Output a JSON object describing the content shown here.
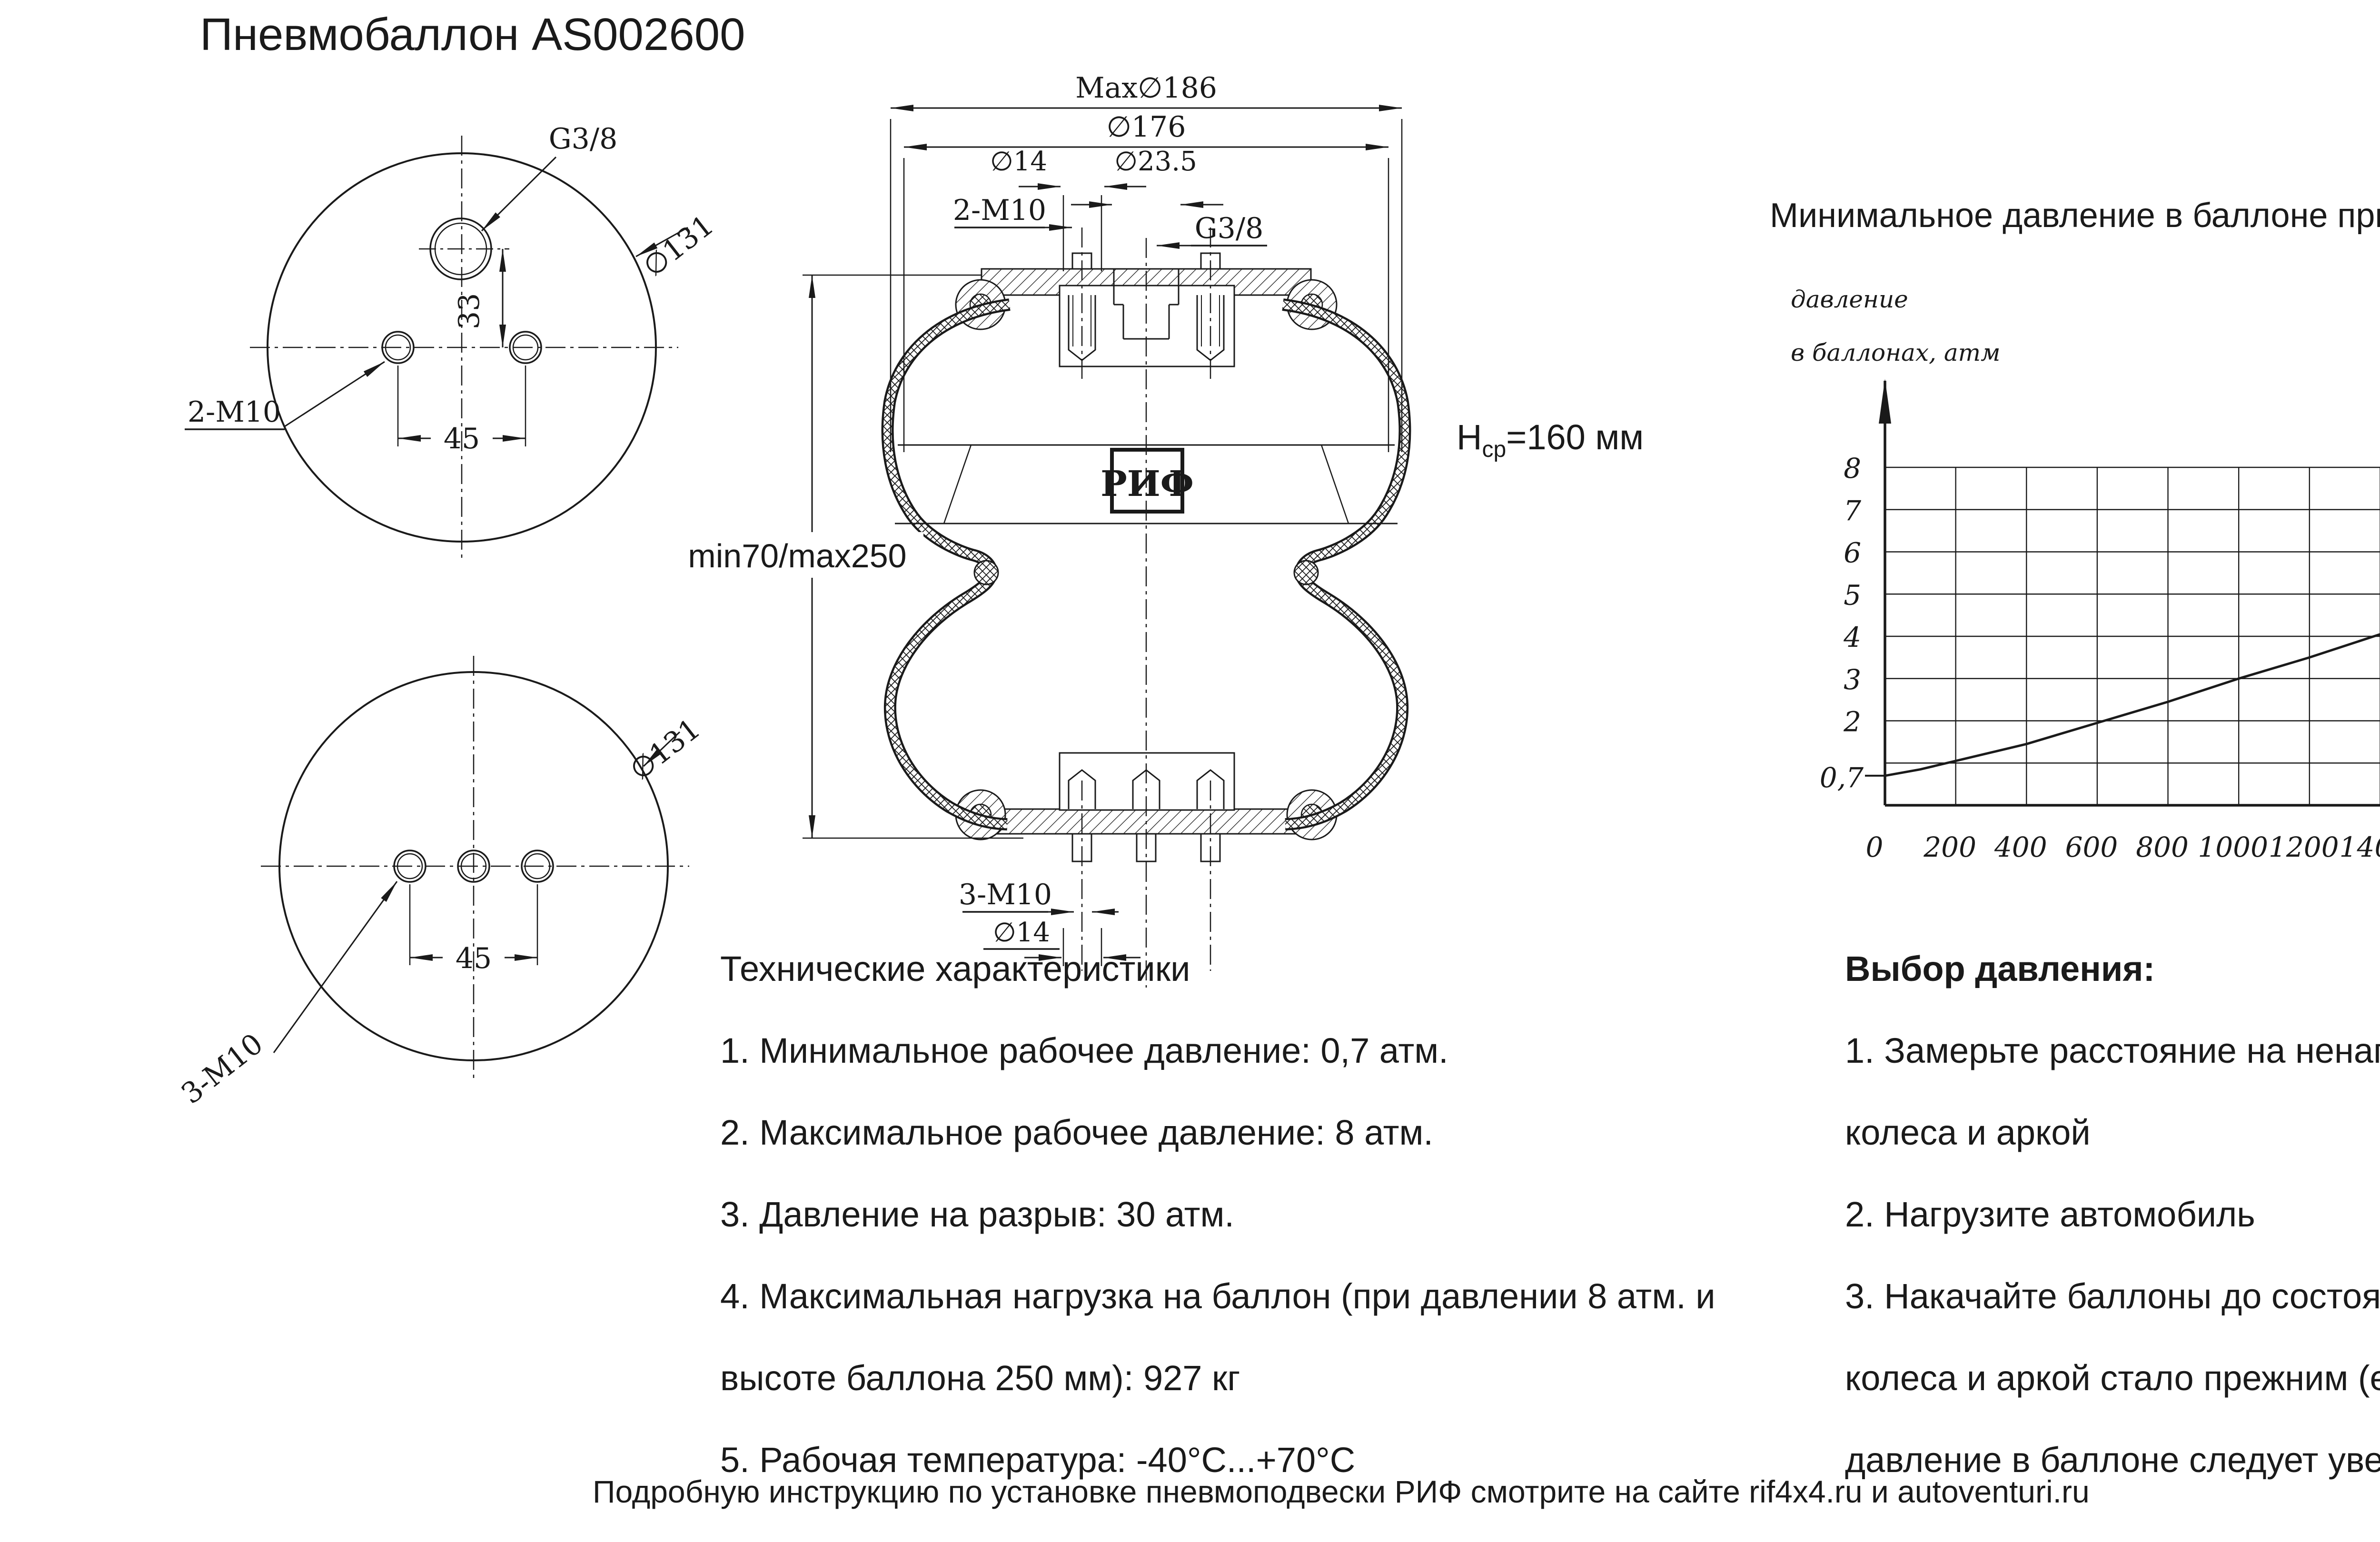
{
  "colors": {
    "ink": "#1a1a1a",
    "bg": "#ffffff"
  },
  "header": {
    "title": "Пневмобаллон  AS002600"
  },
  "footer": {
    "text": "Подробную инструкцию по установке пневмоподвески РИФ смотрите на сайте rif4x4.ru и autoventuri.ru"
  },
  "specs": {
    "heading": "Технические характеристики",
    "lines": [
      "1. Минимальное рабочее давление: 0,7 атм.",
      "2. Максимальное рабочее давление: 8 атм.",
      "3. Давление на разрыв: 30 атм.",
      "4. Максимальная нагрузка на баллон (при давлении 8 атм. и",
      "высоте баллона 250 мм): 927 кг",
      "5. Рабочая температура: -40°C...+70°C"
    ]
  },
  "pressure": {
    "heading": "Выбор давления:",
    "lines": [
      "1. Замерьте расстояние на ненагруженном автомобиле между центром",
      "колеса и аркой",
      "2. Нагрузите автомобиль",
      "3. Накачайте баллоны до состояния, чтобы расстояние между центром",
      "колеса и аркой стало прежним (если Вы хотите приподнять автомобиль,",
      "давление в баллоне следует увеличить)"
    ]
  },
  "drawing": {
    "top_flange": {
      "port": "G3/8",
      "diameter": "∅131",
      "holes": "2-M10",
      "dim_v": "33",
      "dim_h": "45"
    },
    "bottom_flange": {
      "diameter": "∅131",
      "holes": "3-M10",
      "dim_h": "45"
    },
    "section": {
      "dim_max": "Max∅186",
      "dim_outer": "∅176",
      "dim_stud": "∅14",
      "dim_port": "∅23.5",
      "studs_top": "2-M10",
      "port_thread": "G3/8",
      "logo": "РИФ",
      "stroke_range": "min70/max250",
      "height_h": "H",
      "height_sub": "ср",
      "height_val": "=160 мм",
      "studs_bottom": "3-M10",
      "dim_stud_b": "∅14"
    }
  },
  "chart_data": {
    "type": "line",
    "title": "Минимальное давление в баллоне при нагрузке на заднюю ось автомобиля",
    "ylabel_lines": [
      "давление",
      "в баллонах, атм"
    ],
    "xlabel_lines": [
      "нагрузка на заднюю",
      "ось а/м, кг"
    ],
    "x_range": [
      0,
      2200
    ],
    "x_ticks": [
      0,
      200,
      400,
      600,
      800,
      1000,
      1200,
      1400,
      1600,
      1800,
      2000
    ],
    "y_gridlines": [
      1,
      2,
      3,
      4,
      5,
      6,
      7,
      8
    ],
    "y_ticks": [
      2,
      3,
      4,
      5,
      6,
      7,
      8
    ],
    "y_start_label": "0,7",
    "ylim": [
      0,
      8.6
    ],
    "grid": true,
    "legend": false,
    "points": [
      [
        0,
        0.7
      ],
      [
        100,
        0.85
      ],
      [
        200,
        1.05
      ],
      [
        300,
        1.25
      ],
      [
        400,
        1.45
      ],
      [
        600,
        1.95
      ],
      [
        800,
        2.45
      ],
      [
        1000,
        3.0
      ],
      [
        1200,
        3.5
      ],
      [
        1400,
        4.05
      ],
      [
        1600,
        4.6
      ],
      [
        1800,
        5.1
      ],
      [
        2000,
        5.65
      ],
      [
        2200,
        6.2
      ]
    ]
  }
}
